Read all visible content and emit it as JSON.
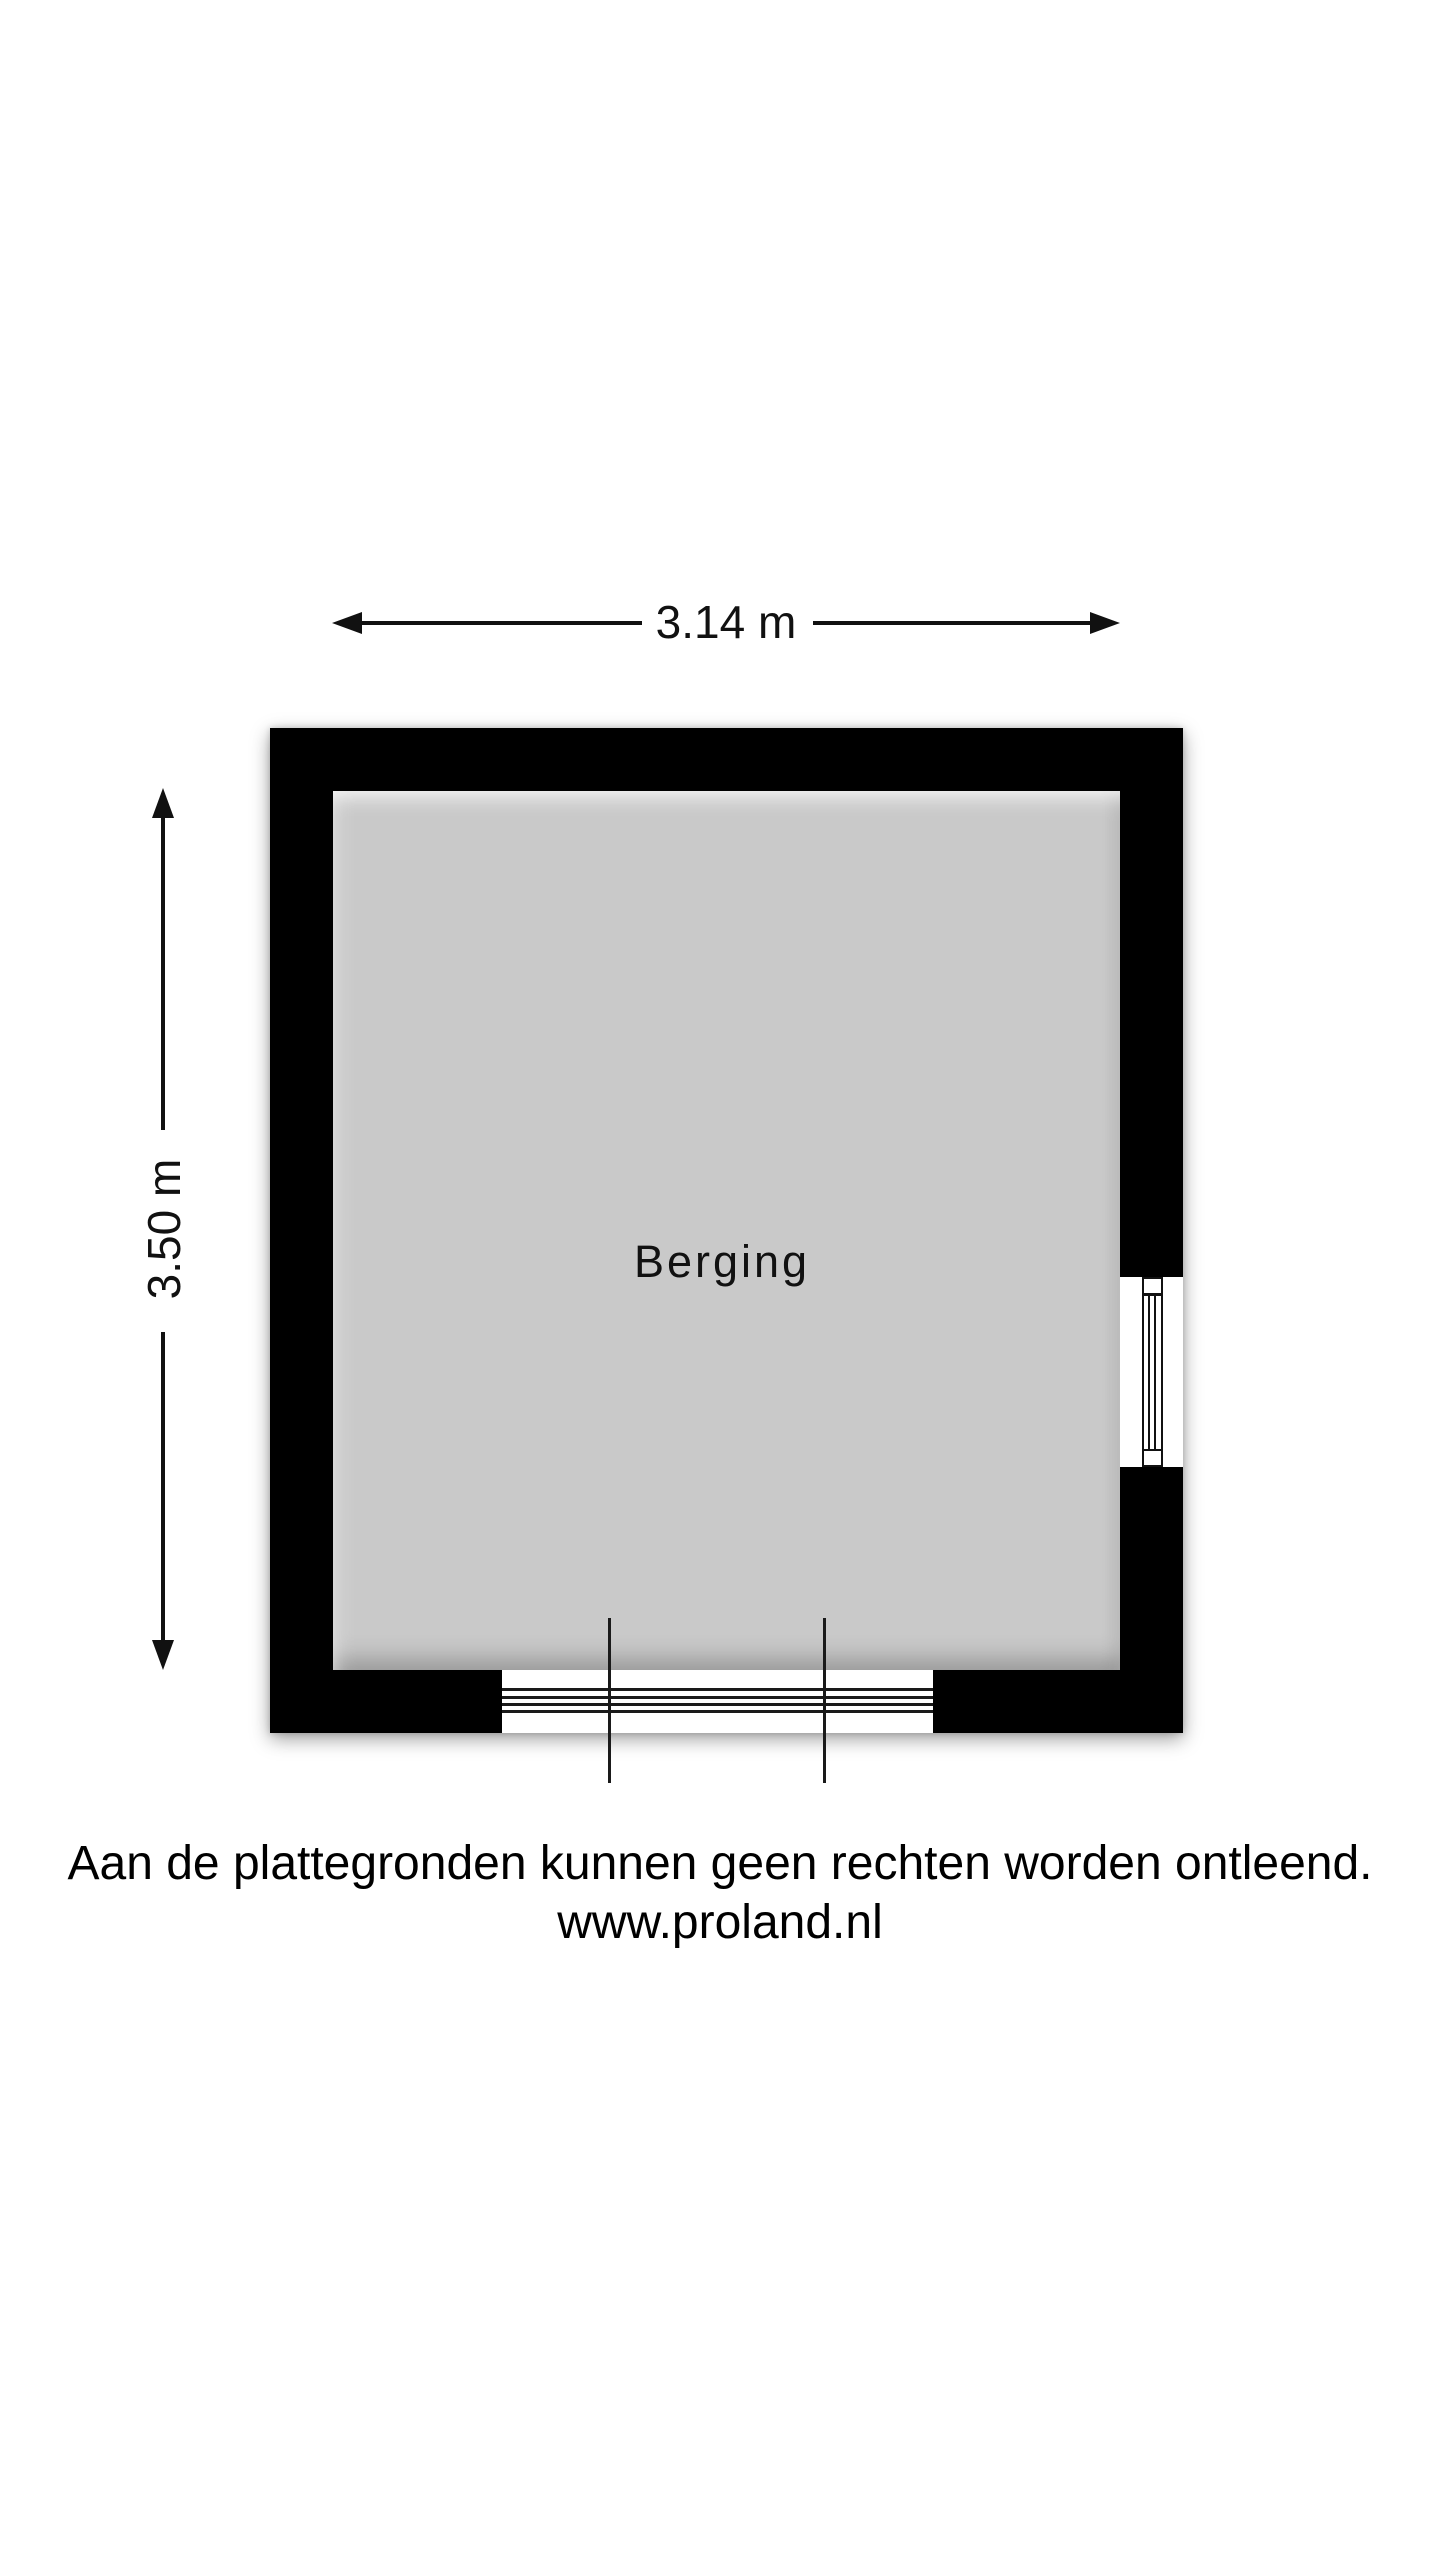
{
  "floorplan": {
    "room": {
      "name": "Berging",
      "floor_color": "#c9c9c9",
      "wall_color": "#000000"
    },
    "dimensions": {
      "width": "3.14 m",
      "height": "3.50 m"
    },
    "features": {
      "window": "window-on-right-wall",
      "door": "threshold-opening-on-bottom-wall"
    }
  },
  "footer": {
    "disclaimer": "Aan de plattegronden kunnen geen rechten worden ontleend.",
    "website": "www.proland.nl"
  }
}
